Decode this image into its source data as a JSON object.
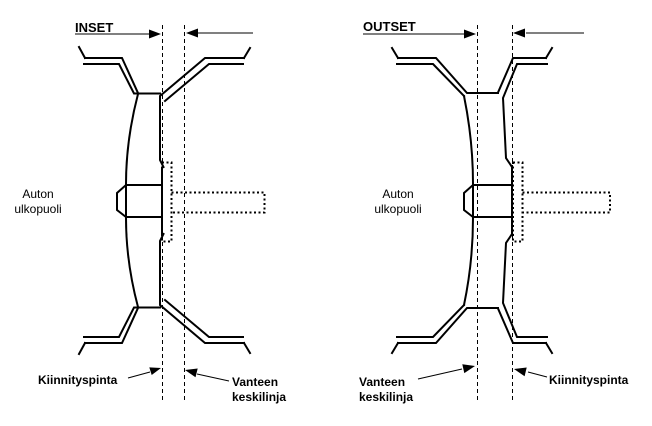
{
  "colors": {
    "ink": "#000000",
    "background": "#ffffff"
  },
  "diagrams": {
    "inset": {
      "title": "INSET",
      "outside_label": {
        "line1": "Auton",
        "line2": "ulkopuoli"
      },
      "mounting_surface_label": "Kiinnityspinta",
      "centerline_label": {
        "line1": "Vanteen",
        "line2": "keskilinja"
      }
    },
    "outset": {
      "title": "OUTSET",
      "outside_label": {
        "line1": "Auton",
        "line2": "ulkopuoli"
      },
      "mounting_surface_label": "Kiinnityspinta",
      "centerline_label": {
        "line1": "Vanteen",
        "line2": "keskilinja"
      }
    }
  }
}
